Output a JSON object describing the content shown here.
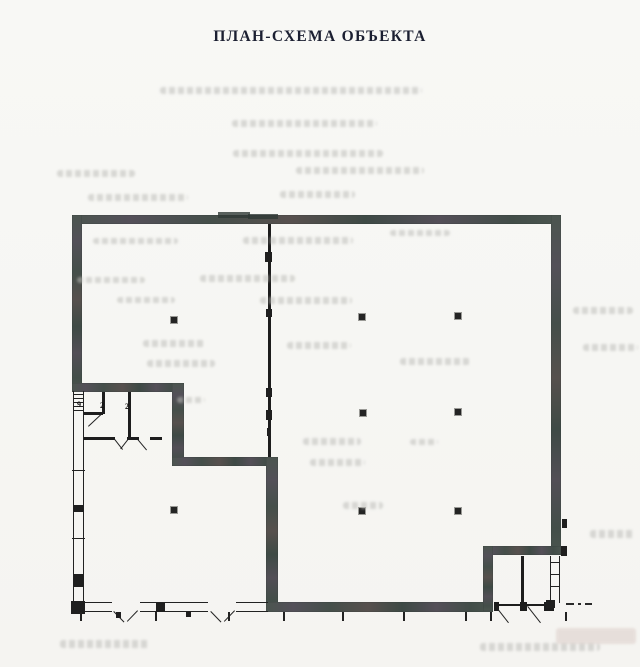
{
  "page": {
    "title": "ПЛАН-СХЕМА ОБЪЕКТА",
    "background": "#f7f7f4",
    "title_color": "#1b1f31"
  },
  "plan": {
    "colors": {
      "thick_wall": "#46514c",
      "thick_wall_tint_purple": "#545059",
      "thick_wall_tint_brown": "#57504e",
      "thin_wall": "#1d1d1d",
      "column": "#242424",
      "bleed_text": "#bdbdb9"
    },
    "thick_walls": [
      [
        72,
        215,
        489,
        9
      ],
      [
        72,
        215,
        10,
        177
      ],
      [
        72,
        383,
        112,
        9
      ],
      [
        172,
        383,
        12,
        83
      ],
      [
        172,
        457,
        105,
        9
      ],
      [
        266,
        457,
        12,
        155
      ],
      [
        266,
        602,
        227,
        10
      ],
      [
        551,
        215,
        10,
        340
      ],
      [
        483,
        546,
        78,
        9
      ],
      [
        483,
        546,
        10,
        65
      ]
    ],
    "wall_shadows": [
      [
        218,
        212,
        32,
        6
      ],
      [
        248,
        214,
        30,
        5
      ]
    ],
    "thin_walls": [
      [
        268,
        224,
        3,
        233
      ],
      [
        102,
        392,
        3,
        22
      ],
      [
        128,
        392,
        3,
        47
      ],
      [
        84,
        412,
        19,
        3
      ],
      [
        84,
        437,
        31,
        3
      ],
      [
        127,
        437,
        12,
        3
      ],
      [
        150,
        437,
        12,
        3
      ],
      [
        88,
        412,
        14,
        2
      ],
      [
        521,
        556,
        3,
        48
      ],
      [
        494,
        602,
        5,
        9
      ],
      [
        520,
        602,
        7,
        9
      ],
      [
        544,
        602,
        10,
        9
      ],
      [
        499,
        604,
        21,
        2
      ],
      [
        527,
        604,
        17,
        2
      ]
    ],
    "double_walls_v": [
      [
        73,
        391,
        11,
        212
      ],
      [
        550,
        556,
        10,
        47
      ]
    ],
    "double_walls_h": [
      [
        75,
        602,
        37,
        10
      ],
      [
        140,
        602,
        68,
        10
      ],
      [
        236,
        602,
        32,
        10
      ]
    ],
    "wall_blobs": [
      [
        265,
        252,
        7,
        10
      ],
      [
        266,
        309,
        6,
        8
      ],
      [
        266,
        388,
        6,
        9
      ],
      [
        266,
        410,
        6,
        10
      ],
      [
        267,
        428,
        4,
        8
      ],
      [
        73,
        505,
        11,
        7
      ],
      [
        73,
        574,
        11,
        13
      ],
      [
        156,
        602,
        9,
        10
      ],
      [
        71,
        601,
        14,
        13
      ],
      [
        546,
        600,
        9,
        8
      ],
      [
        562,
        519,
        5,
        9
      ],
      [
        561,
        546,
        6,
        10
      ]
    ],
    "columns": [
      [
        171,
        317
      ],
      [
        359,
        314
      ],
      [
        455,
        313
      ],
      [
        360,
        410
      ],
      [
        455,
        409
      ],
      [
        171,
        507
      ],
      [
        359,
        508
      ],
      [
        455,
        508
      ]
    ],
    "door_swings": [
      [
        88,
        426,
        19,
        -43
      ],
      [
        115,
        439,
        13,
        52
      ],
      [
        129,
        439,
        13,
        128
      ],
      [
        138,
        439,
        14,
        50
      ],
      [
        114,
        611,
        15,
        46
      ],
      [
        138,
        611,
        15,
        134
      ],
      [
        211,
        611,
        15,
        46
      ],
      [
        235,
        611,
        15,
        134
      ],
      [
        496,
        606,
        21,
        52
      ],
      [
        528,
        606,
        21,
        52
      ]
    ],
    "ticks": [
      [
        80,
        612
      ],
      [
        155,
        612
      ],
      [
        228,
        612
      ],
      [
        283,
        612
      ],
      [
        342,
        612
      ],
      [
        403,
        612
      ],
      [
        465,
        612
      ],
      [
        490,
        612
      ],
      [
        565,
        612
      ]
    ],
    "tick_blobs": [
      [
        116,
        612,
        5,
        6
      ],
      [
        186,
        611,
        5,
        6
      ]
    ],
    "rungs": [
      [
        74,
        394,
        9
      ],
      [
        74,
        398,
        9
      ],
      [
        74,
        402,
        9
      ],
      [
        74,
        406,
        9
      ],
      [
        74,
        410,
        9
      ],
      [
        72,
        470,
        13
      ],
      [
        72,
        538,
        13
      ],
      [
        551,
        562,
        8
      ],
      [
        551,
        574,
        8
      ],
      [
        551,
        586,
        8
      ]
    ],
    "dashes": [
      [
        566,
        603,
        8
      ],
      [
        578,
        603,
        3
      ],
      [
        585,
        603,
        7
      ]
    ],
    "room_labels": [
      {
        "text": "9",
        "x": 77,
        "y": 401
      },
      {
        "text": "2",
        "x": 100,
        "y": 402
      },
      {
        "text": "2",
        "x": 125,
        "y": 403
      }
    ],
    "bleed_marks": [
      [
        160,
        87,
        262,
        7
      ],
      [
        232,
        120,
        145,
        7
      ],
      [
        233,
        150,
        150,
        7
      ],
      [
        57,
        170,
        78,
        7
      ],
      [
        296,
        167,
        128,
        7
      ],
      [
        88,
        194,
        100,
        7
      ],
      [
        280,
        191,
        75,
        7
      ],
      [
        93,
        238,
        85,
        6
      ],
      [
        243,
        237,
        110,
        7
      ],
      [
        390,
        230,
        60,
        6
      ],
      [
        77,
        277,
        68,
        6
      ],
      [
        200,
        275,
        95,
        7
      ],
      [
        573,
        307,
        60,
        7
      ],
      [
        117,
        297,
        58,
        6
      ],
      [
        260,
        297,
        92,
        7
      ],
      [
        143,
        340,
        62,
        7
      ],
      [
        287,
        342,
        64,
        7
      ],
      [
        583,
        344,
        55,
        7
      ],
      [
        147,
        360,
        68,
        7
      ],
      [
        400,
        358,
        70,
        7
      ],
      [
        177,
        397,
        28,
        6
      ],
      [
        303,
        438,
        58,
        7
      ],
      [
        410,
        439,
        28,
        6
      ],
      [
        310,
        459,
        55,
        7
      ],
      [
        343,
        502,
        40,
        7
      ],
      [
        590,
        530,
        45,
        8
      ],
      [
        60,
        640,
        90,
        8
      ],
      [
        480,
        643,
        120,
        8
      ]
    ],
    "bleed_warm": [
      [
        556,
        628,
        80,
        16
      ]
    ]
  }
}
